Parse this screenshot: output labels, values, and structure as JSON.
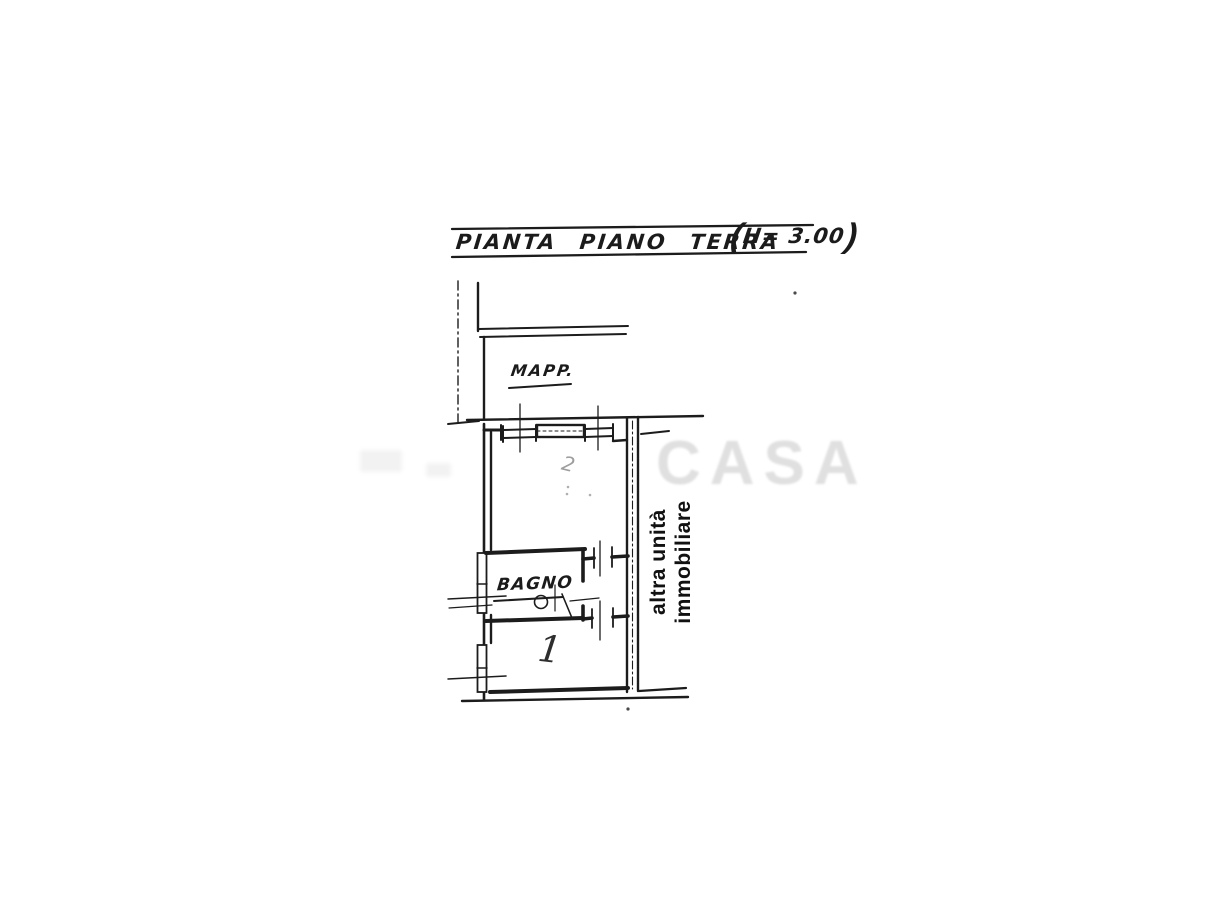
{
  "document": {
    "type": "scanned floor plan",
    "background": "#ffffff",
    "ink_color": "#1c1c1c"
  },
  "title": {
    "main": "PIANTA PIANO TERRA",
    "paren_open": "(",
    "height_note": "H= 3.00",
    "paren_close": ")"
  },
  "labels": {
    "mapp": "MAPP.",
    "bagno": "BAGNO",
    "room_main_number": "2",
    "room_bottom_number": "1",
    "adjacent_unit_line1": "altra unità",
    "adjacent_unit_line2": "immobiliare"
  },
  "watermark": {
    "visible_text": "CASA"
  },
  "colors": {
    "ink": "#1c1c1c",
    "pencil_gray": "#9e9e9e",
    "watermark_gray": "rgba(70,70,70,0.17)"
  }
}
